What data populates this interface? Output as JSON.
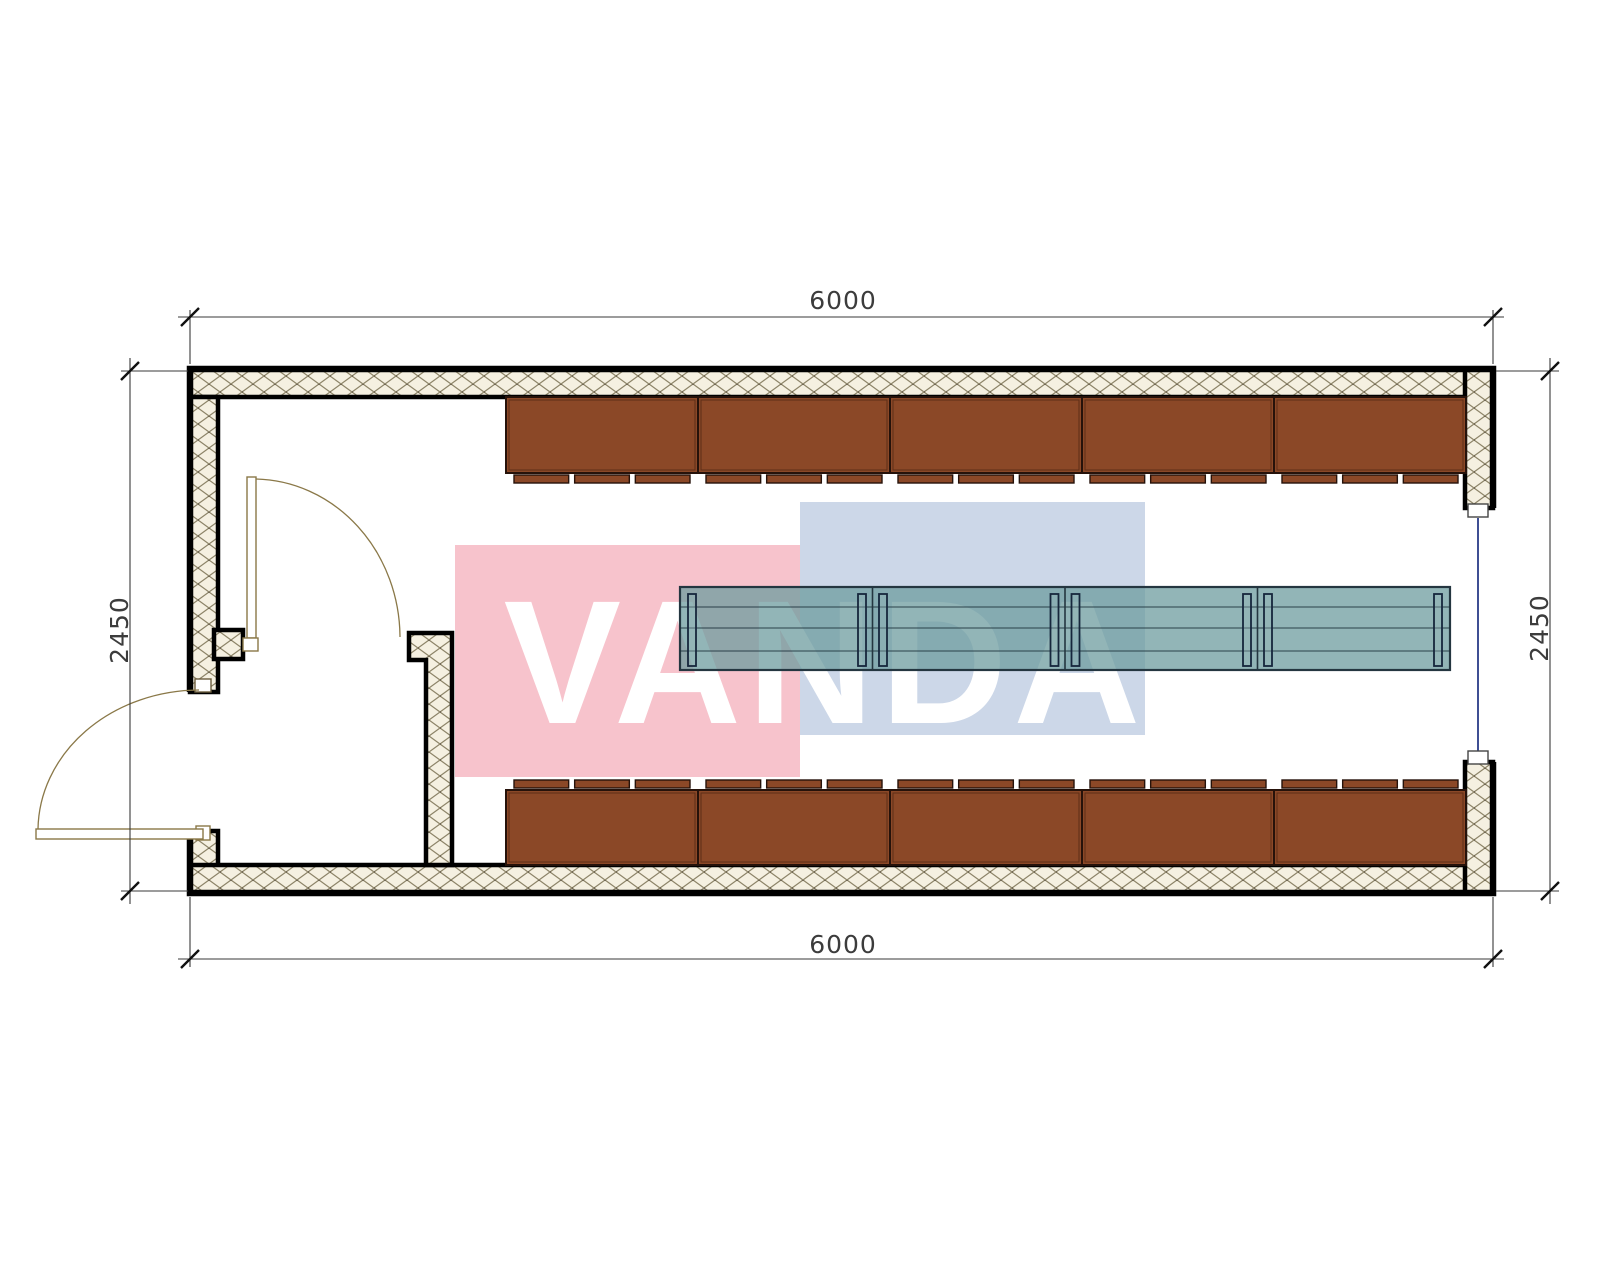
{
  "watermark": {
    "text": "VANDA",
    "pink_color": "#F7C3CC",
    "blue_color": "#CCD7E8",
    "text_color": "#FFFFFF"
  },
  "dimensions": {
    "top": "6000",
    "bottom": "6000",
    "left": "2450",
    "right": "2450"
  },
  "palette": {
    "cabinet_fill": "#8B4827",
    "cabinet_outline": "#26120A",
    "bench_fill_rgba": "rgba(109,156,159,0.75)",
    "bench_leg_fill_rgba": "rgba(150,180,184,0.35)",
    "bench_outline": "#243640",
    "bench_line_rgba": "rgba(25,45,55,0.85)",
    "wall_hatch_bg": "#F5F0E1",
    "wall_hatch_line": "#8D8468",
    "door_color": "#8A7848",
    "window_line_color": "#3F4F93",
    "dim_line_color": "#3A3A3A"
  },
  "furniture": {
    "cabinet_rows": 2,
    "cabinets_per_row": 5,
    "bench_sections": 4,
    "strip_segments_per_cabinet": 3
  }
}
